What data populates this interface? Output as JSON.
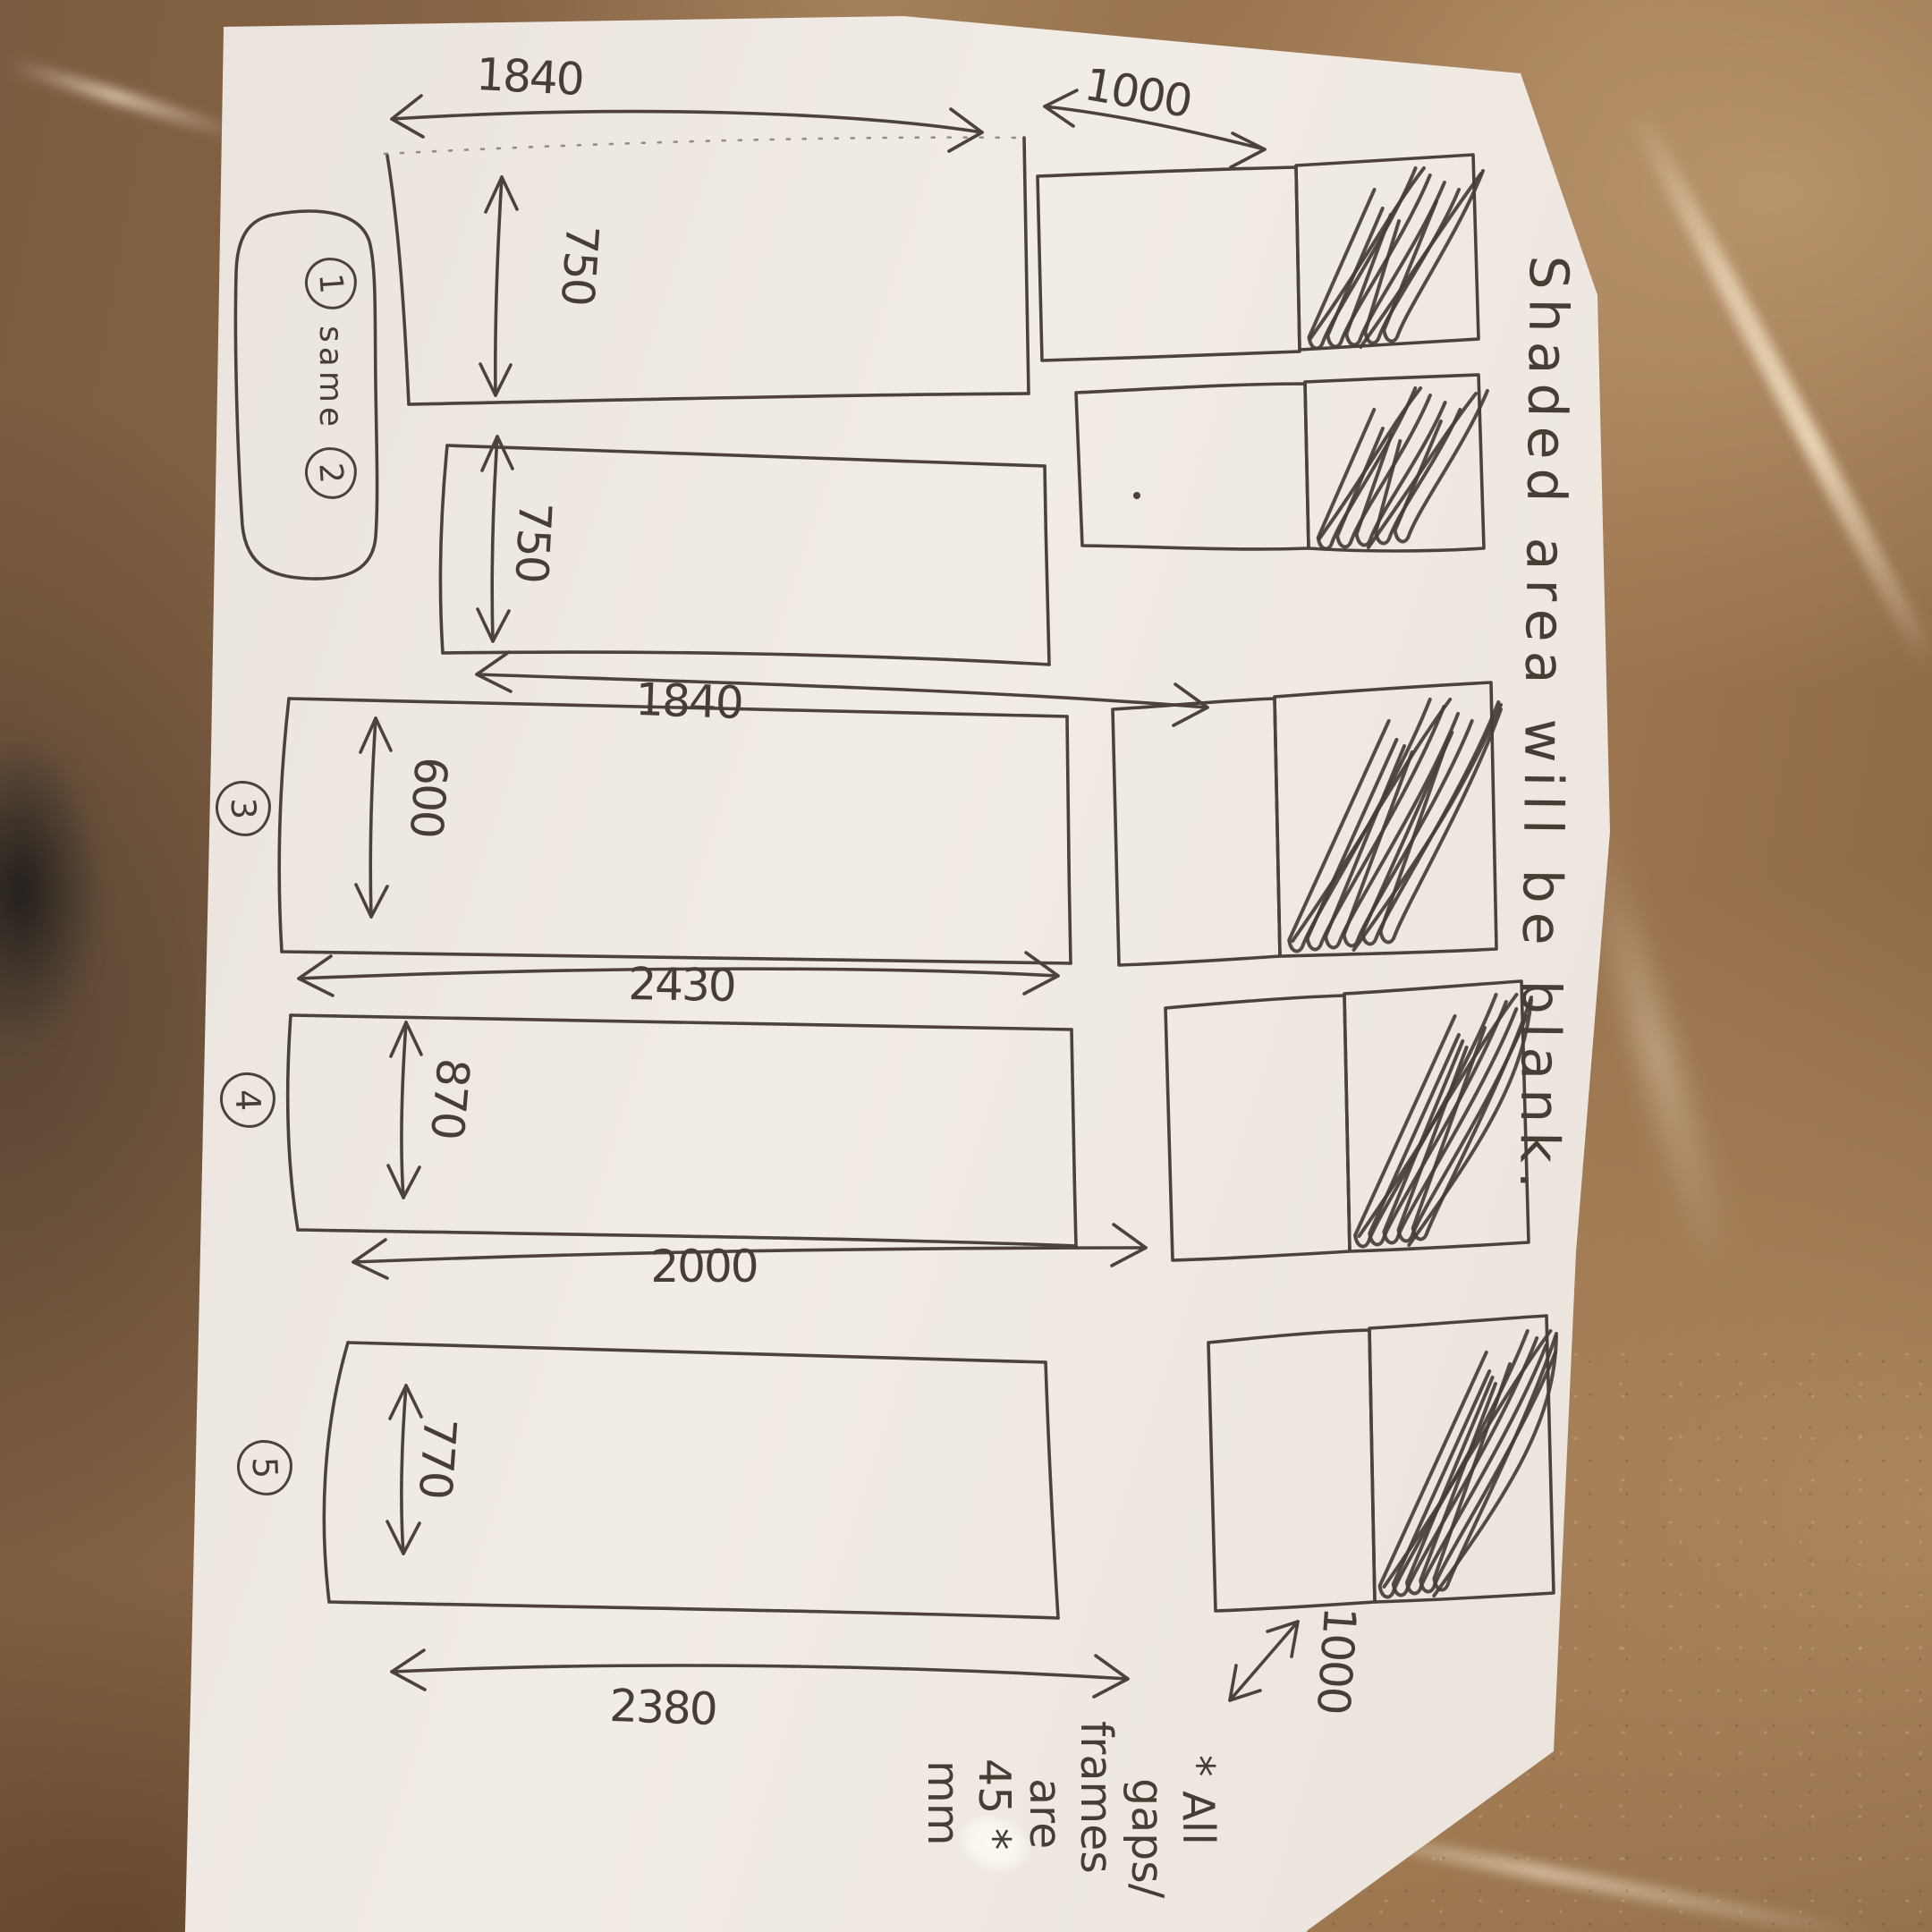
{
  "sketch": {
    "vertical_note": "Shaded area will be blank.",
    "bubble": {
      "num1": "1",
      "word": "same",
      "num2": "2"
    },
    "circled": {
      "p3": "3",
      "p4": "4",
      "p5": "5"
    },
    "dims": {
      "row1_width": "1840",
      "row1_height": "750",
      "row2_width": "1840",
      "row2_height": "750",
      "row3_width": "2430",
      "row3_height": "600",
      "row4_width": "2000",
      "row4_height": "870",
      "row5_width": "2380",
      "row5_height": "770",
      "right_col_width_top": "1000",
      "right_col_width_bottom": "1000"
    },
    "footnote_lines": [
      "* All",
      "gaps/",
      "frames",
      "are",
      "45 *",
      "mm"
    ]
  }
}
